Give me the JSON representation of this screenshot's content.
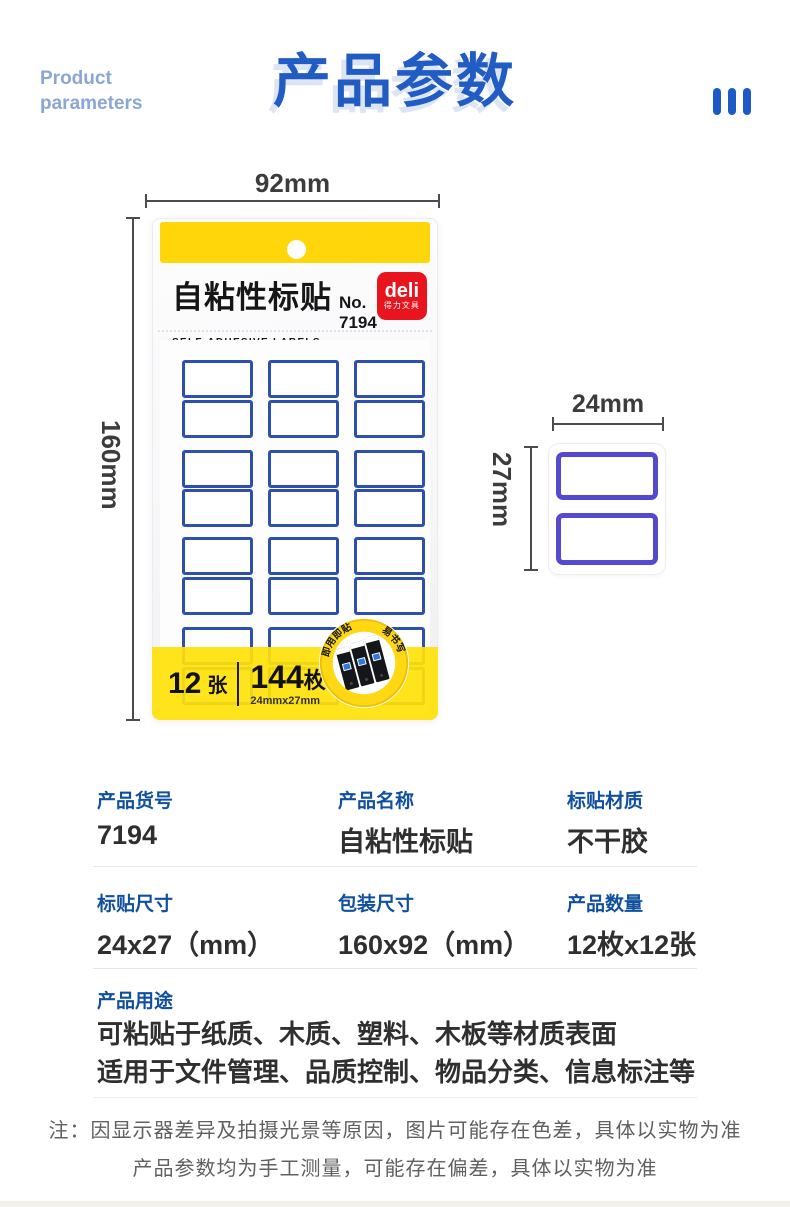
{
  "header": {
    "subtitle_line1": "Product",
    "subtitle_line2": "parameters",
    "title": "产品参数"
  },
  "figure": {
    "dims": {
      "package_width": "92mm",
      "package_height": "160mm",
      "label_width": "24mm",
      "label_height": "27mm"
    },
    "package": {
      "title_cn": "自粘性标贴",
      "model_no": "No. 7194",
      "title_en": "SELF-ADHESIVE LABELS",
      "brand_name": "deli",
      "brand_cn": "得力文具",
      "sheets_count": "12",
      "sheets_unit": "张",
      "labels_count": "144",
      "labels_unit": "枚",
      "label_size": "24mmx27mm",
      "badge_text_1": "即用即贴",
      "badge_text_2": "易书写"
    }
  },
  "params": {
    "rows": [
      {
        "label": "产品货号",
        "value": "7194"
      },
      {
        "label": "产品名称",
        "value": "自粘性标贴"
      },
      {
        "label": "标贴材质",
        "value": "不干胶"
      },
      {
        "label": "标贴尺寸",
        "value": "24x27（mm）"
      },
      {
        "label": "包装尺寸",
        "value": "160x92（mm）"
      },
      {
        "label": "产品数量",
        "value": "12枚x12张"
      }
    ],
    "usage": {
      "label": "产品用途",
      "line1": "可粘贴于纸质、木质、塑料、木板等材质表面",
      "line2": "适用于文件管理、品质控制、物品分类、信息标注等"
    }
  },
  "note": {
    "line1": "注：因显示器差异及拍摄光景等原因，图片可能存在色差，具体以实物为准",
    "line2": "产品参数均为手工测量，可能存在偏差，具体以实物为准"
  },
  "colors": {
    "accent_blue": "#205cc4",
    "subtitle_blue": "#8aa5d8",
    "table_label_blue": "#10509f",
    "package_yellow": "#ffd60a",
    "band_yellow": "#ffe108",
    "sheet_label_border": "#2d4fae",
    "mini_label_border": "#5449cf",
    "deli_red": "#e8141e"
  }
}
